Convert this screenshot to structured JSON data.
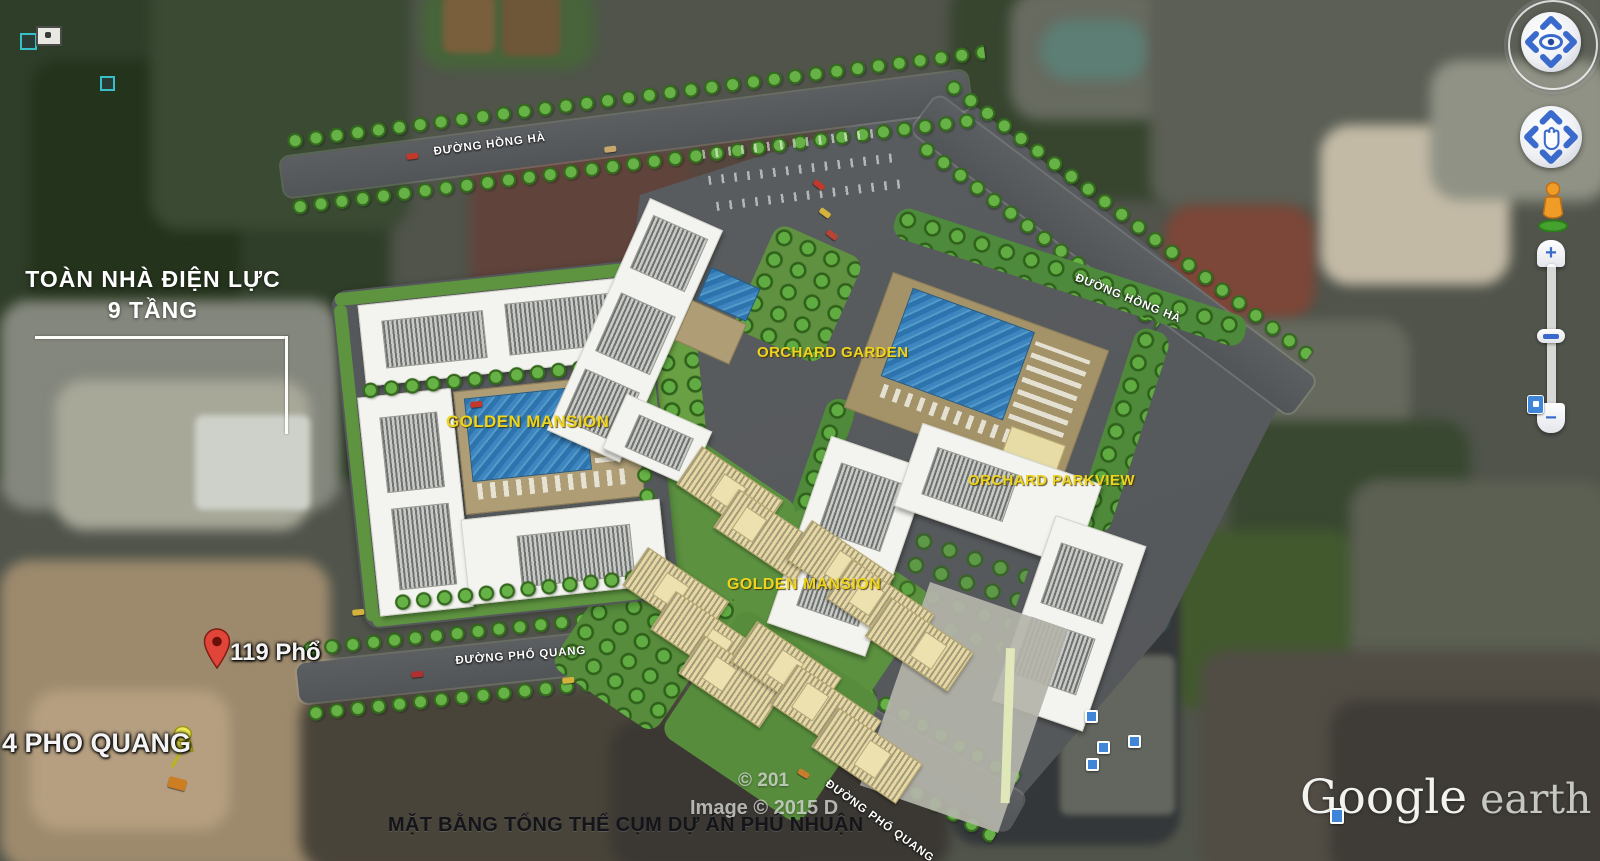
{
  "app": {
    "name": "Google Earth"
  },
  "site_plan": {
    "callout": {
      "line1": "TOÀN NHÀ ĐIỆN LỰC",
      "line2": "9 TẦNG"
    },
    "streets": {
      "hong_ha": "ĐƯỜNG HỒNG HÀ",
      "pho_quang": "ĐƯỜNG PHỔ QUANG"
    },
    "projects": {
      "golden_mansion": "GOLDEN MANSION",
      "orchard_garden": "ORCHARD GARDEN",
      "orchard_parkview": "ORCHARD PARKVIEW"
    },
    "caption": "MẶT BẰNG TỔNG THỂ CỤM DỰ ÁN PHÚ NHUẬN"
  },
  "pins": {
    "red_pin_label": "119 Phổ",
    "yellow_pushpin_label": "4 PHO QUANG"
  },
  "watermarks": {
    "copyright_line": "© 201",
    "imagery_line": "Image © 2015 D",
    "logo_word1": "Google",
    "logo_word2": "earth"
  },
  "controls": {
    "zoom_in_label": "+",
    "zoom_out_label": "−"
  },
  "colors": {
    "project_label": "#EDD41E",
    "street_label": "#FFFFFF",
    "road_gray": "#57595B",
    "pool_blue": "#3579B4",
    "tree_green": "#4F8F35",
    "control_blue": "#3A6BCC",
    "pin_red": "#DF4434",
    "pushpin_yellow": "#E9E43E"
  }
}
